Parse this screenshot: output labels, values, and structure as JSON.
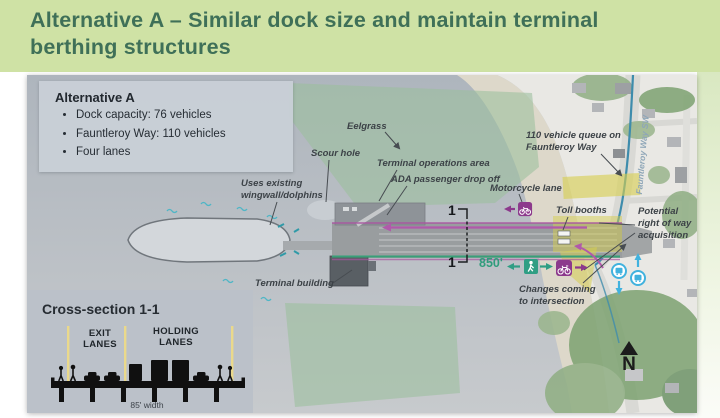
{
  "slide": {
    "title": "Alternative A – Similar dock size and maintain terminal berthing structures"
  },
  "legend": {
    "title": "Alternative A",
    "bullets": [
      "Dock capacity: 76 vehicles",
      "Fauntleroy Way: 110 vehicles",
      "Four lanes"
    ]
  },
  "labels": {
    "eelgrass": "Eelgrass",
    "scour_hole": "Scour hole",
    "terminal_ops": "Terminal operations area",
    "ada": "ADA passenger drop off",
    "motorcycle": "Motorcycle lane",
    "queue": "110 vehicle queue on\nFauntleroy Way",
    "toll_booths": "Toll booths",
    "right_of_way": "Potential\nright of way\nacquisition",
    "changes": "Changes coming\nto intersection",
    "wingwall": "Uses existing\nwingwall/dolphins",
    "terminal_building": "Terminal building",
    "street": "Fauntleroy Way SW",
    "distance": "850'",
    "marker": "1",
    "north": "N"
  },
  "cross_section": {
    "title": "Cross-section 1-1",
    "exit_lanes": "EXIT LANES",
    "holding_lanes": "HOLDING LANES",
    "width": "85' width"
  },
  "colors": {
    "header_bg": "#cfe2a5",
    "header_text": "#3f7058",
    "water": "#b7bdc4",
    "eelgrass": "#9bbf9d",
    "teal_accent": "#2f9e84",
    "purple_accent": "#8c398c",
    "magenta_route": "#b159ab",
    "transit_blue": "#41b2de",
    "highlight_yellow": "#d6ce50",
    "fauntleroy_line": "#3e8cac"
  }
}
